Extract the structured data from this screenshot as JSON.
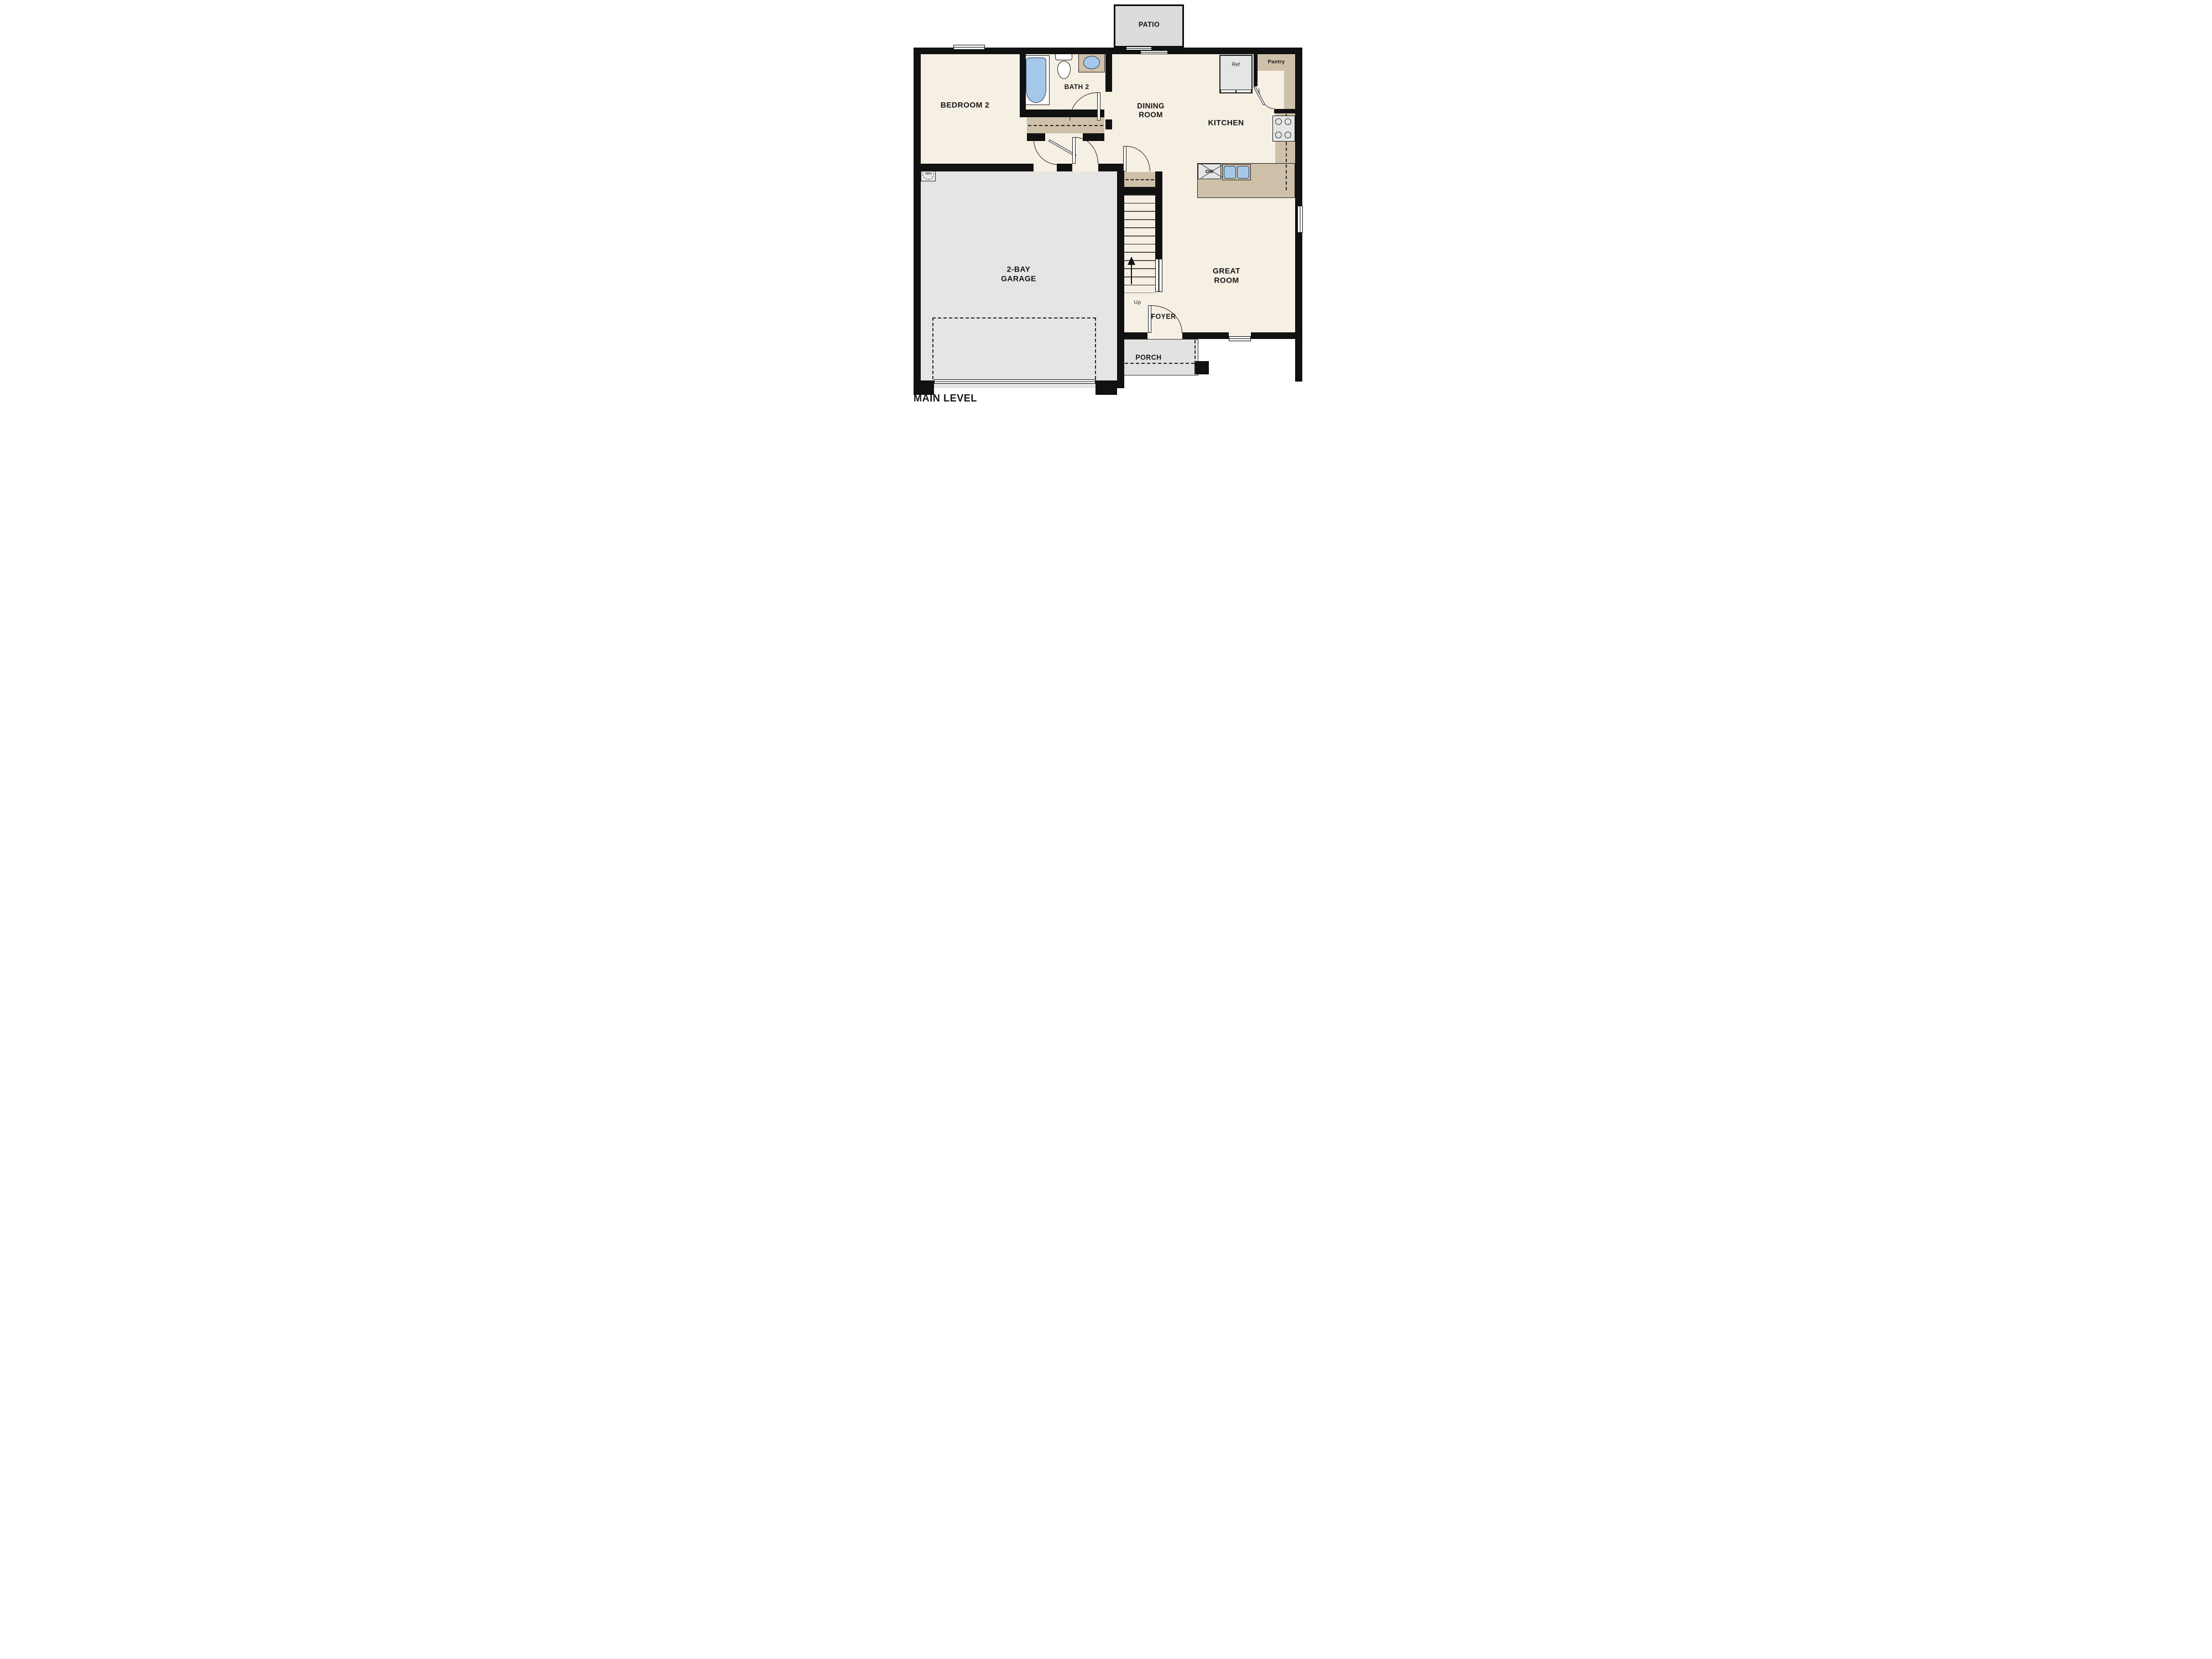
{
  "plan_title": "MAIN LEVEL",
  "rooms": {
    "patio": {
      "label": "PATIO"
    },
    "bedroom2": {
      "label": "BEDROOM 2"
    },
    "bath2": {
      "label": "BATH 2"
    },
    "dining": {
      "line1": "DINING",
      "line2": "ROOM"
    },
    "kitchen": {
      "label": "KITCHEN"
    },
    "pantry": {
      "label": "Pantry"
    },
    "great_room": {
      "line1": "GREAT",
      "line2": "ROOM"
    },
    "garage": {
      "line1": "2-BAY",
      "line2": "GARAGE"
    },
    "foyer": {
      "label": "FOYER"
    },
    "porch": {
      "label": "PORCH"
    }
  },
  "fixtures": {
    "refrigerator": "Ref",
    "dishwasher": "DW",
    "water_heater": "WH",
    "stairs_direction": "Up"
  },
  "colors": {
    "wall": "#111111",
    "line": "#222222",
    "room-cream": "#f6efe4",
    "counter-tan": "#cfc1a9",
    "garage-gray": "#e6e5e3",
    "patio-gray": "#dcdcdc",
    "porch-gray": "#e2e2e0",
    "fixture-gray": "#e4e6e6",
    "water-blue": "#a5c8ea"
  }
}
